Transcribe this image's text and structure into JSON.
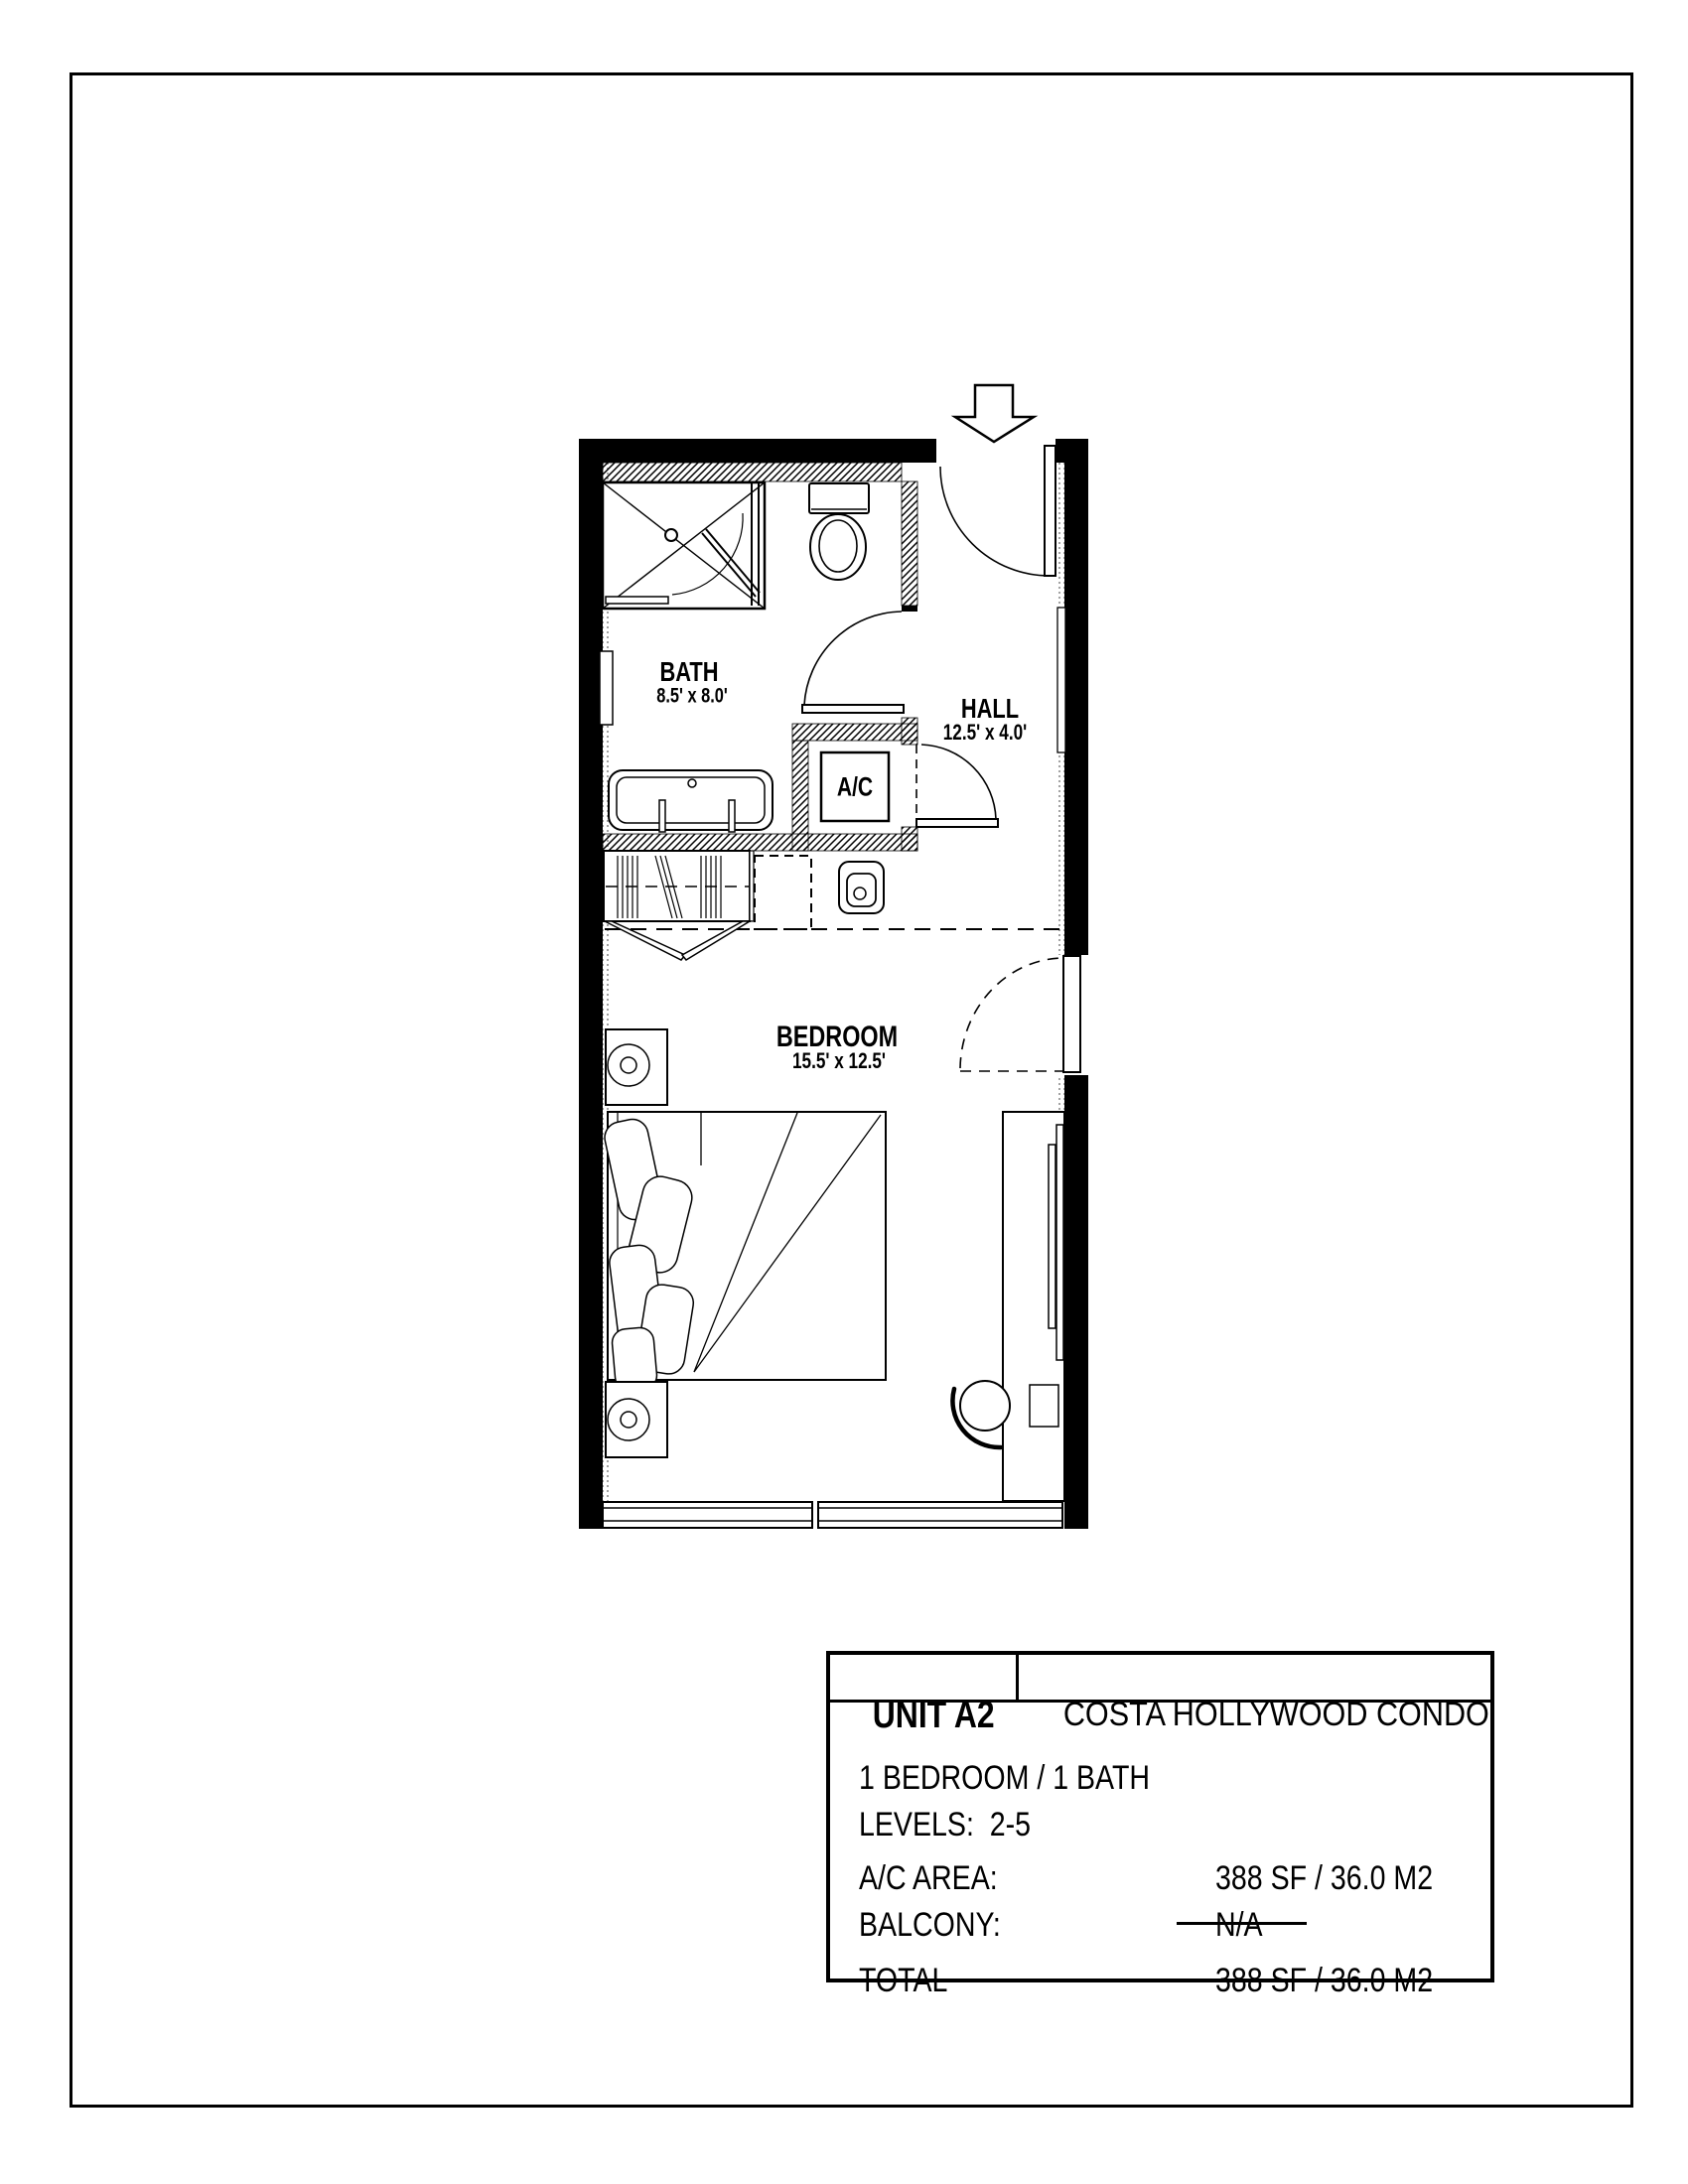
{
  "floor_plan": {
    "rooms": {
      "bath": {
        "name": "BATH",
        "dims": "8.5' x 8.0'"
      },
      "hall": {
        "name": "HALL",
        "dims": "12.5' x 4.0'"
      },
      "bedroom": {
        "name": "BEDROOM",
        "dims": "15.5' x 12.5'"
      },
      "ac_closet": {
        "label": "A/C"
      }
    }
  },
  "title_block": {
    "unit": "UNIT A2",
    "project": "COSTA HOLLYWOOD CONDO",
    "config": "1 BEDROOM / 1 BATH",
    "levels": "LEVELS:  2-5",
    "rows": [
      {
        "label": "A/C AREA:",
        "value": "388 SF / 36.0 M2"
      },
      {
        "label": "BALCONY:",
        "value": "N/A"
      },
      {
        "label": "TOTAL",
        "value": "388 SF / 36.0 M2"
      }
    ]
  }
}
